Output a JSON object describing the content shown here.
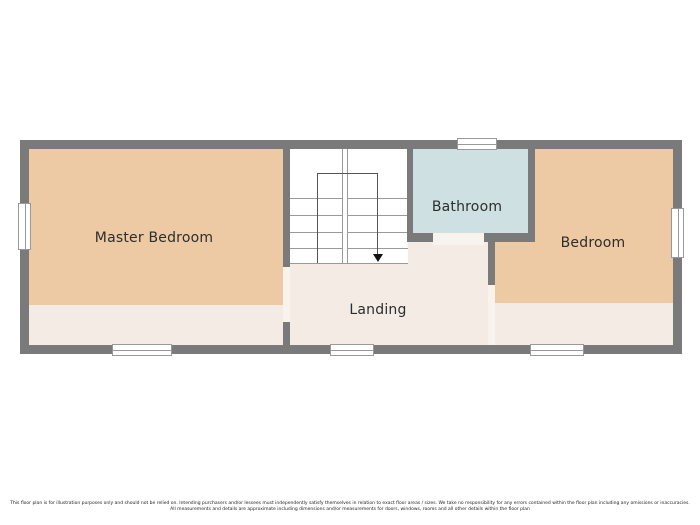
{
  "floor_plan": {
    "title": "First floor plan",
    "rooms": {
      "master_bedroom": {
        "label": "Master Bedroom"
      },
      "bathroom": {
        "label": "Bathroom"
      },
      "bedroom": {
        "label": "Bedroom"
      },
      "landing": {
        "label": "Landing"
      }
    },
    "stairs": {
      "direction": "down"
    },
    "window_count": 6,
    "colors": {
      "wall": "#7a7a7a",
      "bedroom_fill": "#edcaa4",
      "bathroom_fill": "#cfe0e3",
      "landing_fill": "#f4ebe5",
      "stairs_fill": "#ffffff",
      "window_fill": "#ffffff",
      "threshold_fill": "#f9f3ee"
    }
  },
  "disclaimer": {
    "line1": "This floor plan is for illustration purposes only and should not be relied on. Intending purchasers and/or lessees must independently satisfy themselves in relation to exact floor areas / sizes. We take no responsibility for any errors contained within the floor plan including any omissions or inaccuracies.",
    "line2": "All measurements and details are approximate including dimensions and/or measurements for doors, windows, rooms and all other details within the floor plan"
  }
}
